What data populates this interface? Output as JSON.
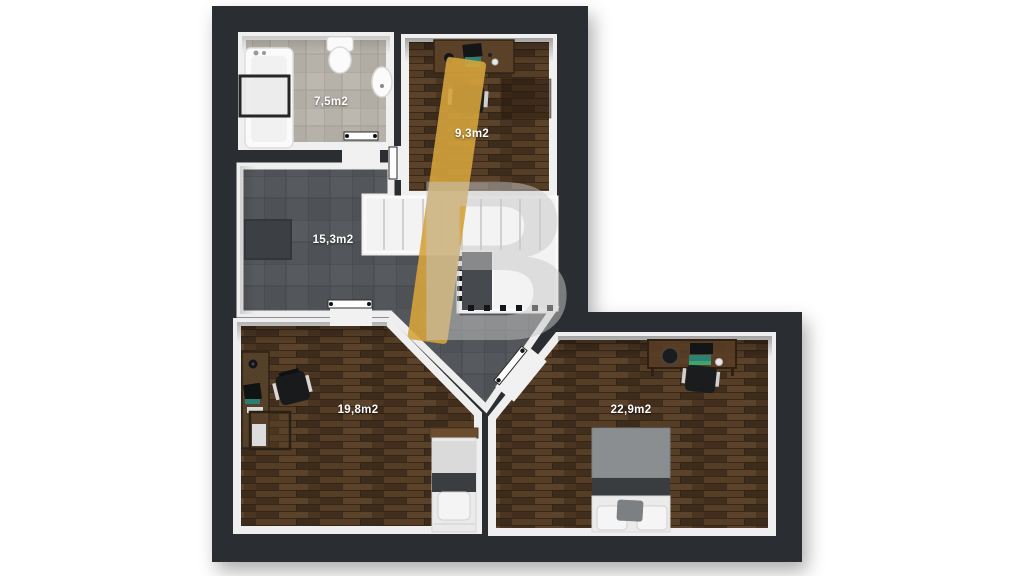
{
  "plan": {
    "wall_color": "#2c2f33",
    "inner_wall_color": "#f0f0f0",
    "accent_gold": "#d5a33c",
    "rooms": [
      {
        "id": "bathroom",
        "area_label": "7,5m2"
      },
      {
        "id": "office",
        "area_label": "9,3m2"
      },
      {
        "id": "landing-hall",
        "area_label": "15,3m2"
      },
      {
        "id": "bedroom-left",
        "area_label": "19,8m2"
      },
      {
        "id": "bedroom-right",
        "area_label": "22,9m2"
      }
    ],
    "watermark_letter": "B"
  }
}
